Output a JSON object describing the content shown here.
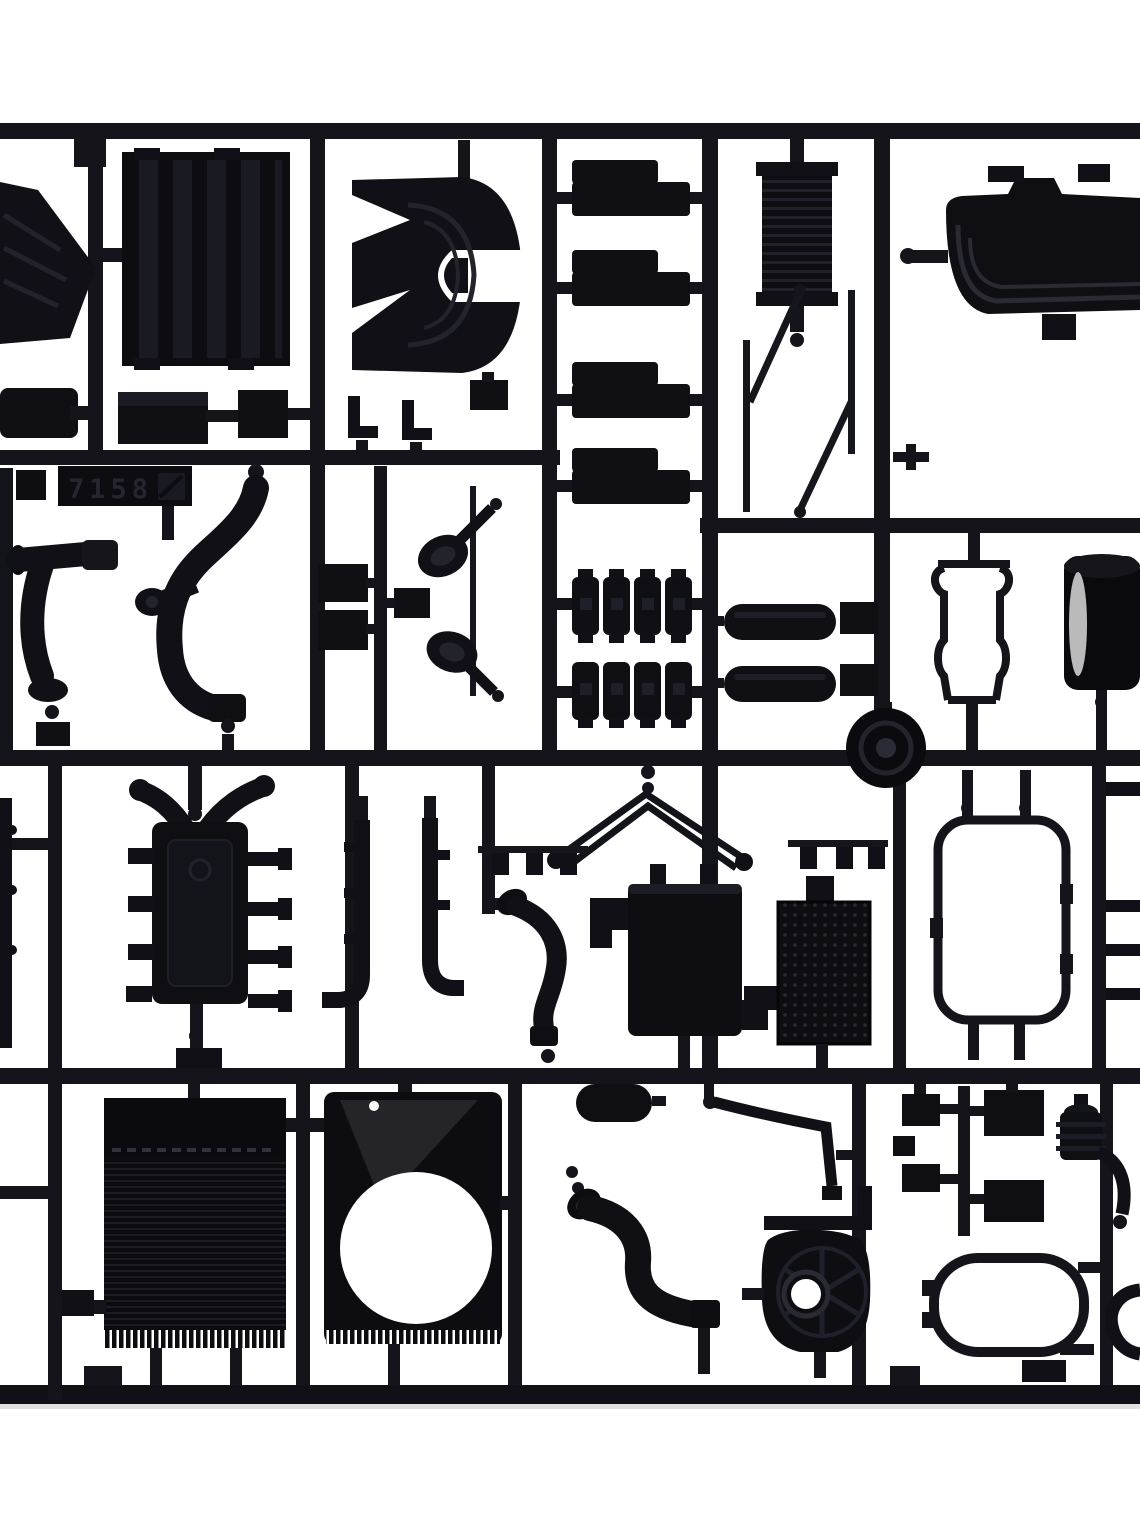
{
  "scene": {
    "type": "photograph",
    "subject": "Black injection-molded plastic model-kit sprue with truck parts on white background",
    "background_color": "#ffffff",
    "plastic_color": "#0f0f14",
    "highlight_color": "#d9d9d9"
  },
  "tag": {
    "code": "7158",
    "mark": "mold-symbol"
  },
  "parts": [
    {
      "label": "Sprue runner frame"
    },
    {
      "label": "Molded part-number tag 7158"
    },
    {
      "label": "Ribbed wedge deflector, cut off at left edge"
    },
    {
      "label": "Ribbed intercooler core"
    },
    {
      "label": "Mounting step plate"
    },
    {
      "label": "Small mounting block"
    },
    {
      "label": "Seat-base brackets"
    },
    {
      "label": "Fifth-wheel coupling plate"
    },
    {
      "label": "Leaf-spring packs"
    },
    {
      "label": "Accordion bellows air filter"
    },
    {
      "label": "Thin rod sprues"
    },
    {
      "label": "Quarter fender, cut off at right edge"
    },
    {
      "label": "S-bend exhaust pipe"
    },
    {
      "label": "Zig-zag intake duct"
    },
    {
      "label": "Small cover plates"
    },
    {
      "label": "Air horns"
    },
    {
      "label": "Engine mount spring blocks"
    },
    {
      "label": "Air reservoir cylinders"
    },
    {
      "label": "Wheel hub disc"
    },
    {
      "label": "Mirror support bracket"
    },
    {
      "label": "Brake drum, cut off at right edge"
    },
    {
      "label": "Engine block with manifold arms"
    },
    {
      "label": "Chassis channel rails"
    },
    {
      "label": "Coolant hose"
    },
    {
      "label": "Roof marker-lamp bar"
    },
    {
      "label": "Battery box"
    },
    {
      "label": "Perforated tread plate"
    },
    {
      "label": "Window gasket frame"
    },
    {
      "label": "Edge bars, cut off at right"
    },
    {
      "label": "Edge strip, cut off at left"
    },
    {
      "label": "Radiator core with fins"
    },
    {
      "label": "Fan shroud with round fan opening"
    },
    {
      "label": "Mirror housing"
    },
    {
      "label": "Wiper arm"
    },
    {
      "label": "S-curve intake pipe"
    },
    {
      "label": "Transfer case with ribbed housing"
    },
    {
      "label": "Equipment boxes"
    },
    {
      "label": "Air compressor with hose"
    },
    {
      "label": "Fuel tank outline frame"
    },
    {
      "label": "J-hook bracket, cut off at edge"
    }
  ]
}
